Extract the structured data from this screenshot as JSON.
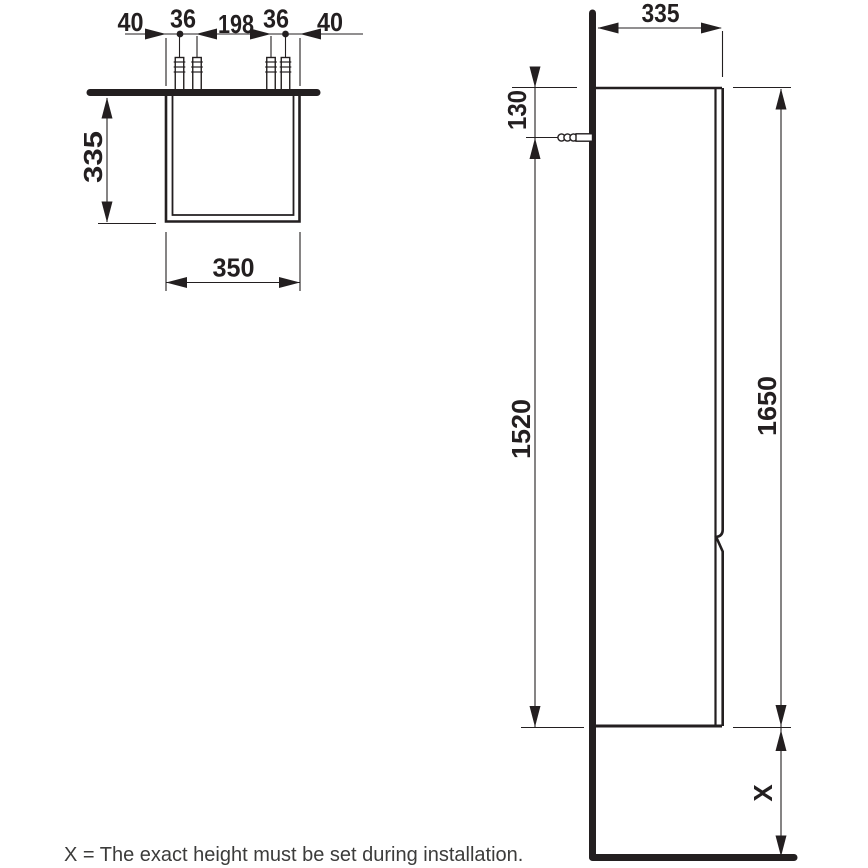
{
  "colors": {
    "line": "#231f20",
    "caption_text": "#3c3c3b",
    "background": "#ffffff"
  },
  "caption": "X = The exact height must be set during installation.",
  "top_view": {
    "dim_40_left": "40",
    "dim_36_left": "36",
    "dim_198": "198",
    "dim_36_right": "36",
    "dim_40_right": "40",
    "dim_depth": "335",
    "dim_width": "350"
  },
  "side_view": {
    "dim_top_width": "335",
    "dim_plug_offset": "130",
    "dim_plug_to_bottom": "1520",
    "dim_total_height": "1650",
    "dim_floor_gap": "X"
  },
  "icons": {
    "wall_plug": "wall-plug-icon"
  }
}
